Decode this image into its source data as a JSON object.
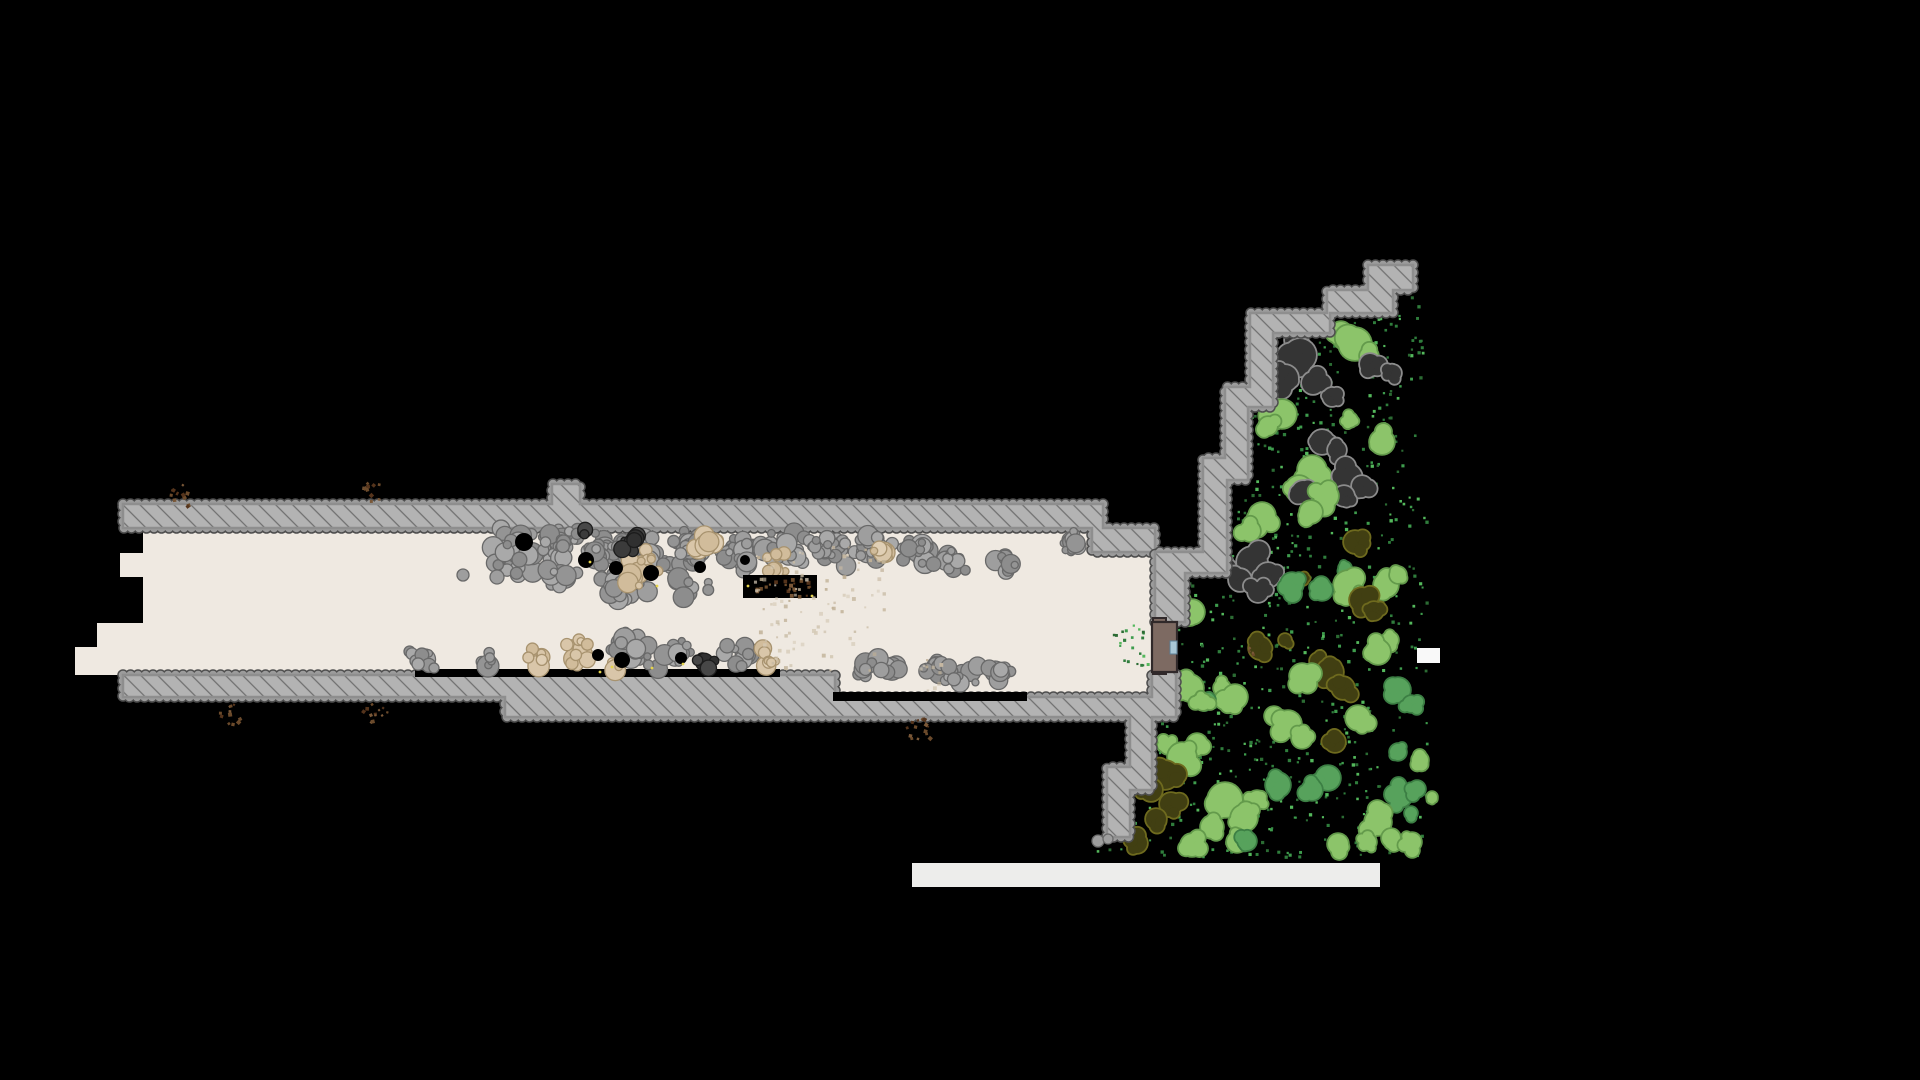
{
  "scene": {
    "width": 1920,
    "height": 1080,
    "background": "#000000",
    "palette": {
      "floor": "#EFE9E1",
      "wall_fill": "#B3B3B3",
      "wall_hatch_line": "#6F6F6F",
      "wall_bump_light": "#9C9C9C",
      "wall_bump_dark": "#4E4E4E",
      "wall_inner_edge": "#8E8E8E",
      "rock_gray": [
        "#9E9E9E",
        "#949494",
        "#A9A9A9",
        "#8D8D8D"
      ],
      "rock_gray_stroke": "#696969",
      "rock_tan": [
        "#D9C6A9",
        "#D1BC9B",
        "#E0CFB5"
      ],
      "rock_tan_stroke": "#A8936F",
      "rock_dark": [
        "#3B3B3B",
        "#303030",
        "#474747"
      ],
      "rock_dark_stroke": "#1C1C1C",
      "tree_lt": {
        "fill": "#8CC46A",
        "stroke": "#639A4B"
      },
      "tree_md": {
        "fill": "#57A25C",
        "stroke": "#3C7F44"
      },
      "tree_ol": {
        "fill": "#413F12",
        "stroke": "#6E6A1E"
      },
      "tree_ch": {
        "fill": "#343434",
        "stroke": "#8C8C8C"
      },
      "grass_dots": [
        "#3E9C4D",
        "#2F7D3C",
        "#54B85C",
        "#2B6B33"
      ],
      "sparkle": "#E5D34B",
      "debris_brown": [
        "#6B4A2B",
        "#7A5838",
        "#55341C"
      ],
      "dust_tan": [
        "#C9BBA4",
        "#BFB096",
        "#D6CBB8"
      ],
      "door_fill": "#7D6A62",
      "door_stroke": "#30292A",
      "window_fill": "#A9C7D6",
      "window_stroke": "#5B7F96",
      "bar_fill": "#EDEDEB",
      "chip_fill": "#F9F9F9",
      "black": "#000000"
    },
    "seed": 1337,
    "floor_polygon": [
      [
        143,
        528
      ],
      [
        1092,
        528
      ],
      [
        1092,
        552
      ],
      [
        1153,
        552
      ],
      [
        1153,
        697
      ],
      [
        835,
        697
      ],
      [
        835,
        675
      ],
      [
        75,
        675
      ],
      [
        75,
        647
      ],
      [
        97,
        647
      ],
      [
        97,
        623
      ],
      [
        143,
        623
      ],
      [
        143,
        577
      ],
      [
        120,
        577
      ],
      [
        120,
        553
      ],
      [
        143,
        553
      ]
    ],
    "walls": [
      {
        "name": "tunnel-top-wall",
        "points": [
          [
            123,
            504
          ],
          [
            552,
            504
          ],
          [
            552,
            484
          ],
          [
            580,
            484
          ],
          [
            580,
            504
          ],
          [
            1103,
            504
          ],
          [
            1103,
            528
          ],
          [
            1155,
            528
          ],
          [
            1155,
            552
          ],
          [
            1092,
            552
          ],
          [
            1092,
            528
          ],
          [
            123,
            528
          ]
        ]
      },
      {
        "name": "garden-upper-stair-wall",
        "points": [
          [
            1185,
            622
          ],
          [
            1185,
            573
          ],
          [
            1227,
            573
          ],
          [
            1227,
            480
          ],
          [
            1248,
            480
          ],
          [
            1248,
            407
          ],
          [
            1273,
            407
          ],
          [
            1273,
            333
          ],
          [
            1330,
            333
          ],
          [
            1330,
            313
          ],
          [
            1393,
            313
          ],
          [
            1393,
            290
          ],
          [
            1413,
            290
          ],
          [
            1413,
            265
          ],
          [
            1368,
            265
          ],
          [
            1368,
            290
          ],
          [
            1327,
            290
          ],
          [
            1327,
            313
          ],
          [
            1250,
            313
          ],
          [
            1250,
            387
          ],
          [
            1225,
            387
          ],
          [
            1225,
            458
          ],
          [
            1203,
            458
          ],
          [
            1203,
            552
          ],
          [
            1155,
            552
          ],
          [
            1155,
            622
          ]
        ]
      },
      {
        "name": "tunnel-bottom-and-lower-stair-wall",
        "points": [
          [
            123,
            675
          ],
          [
            835,
            675
          ],
          [
            835,
            697
          ],
          [
            1152,
            697
          ],
          [
            1152,
            672
          ],
          [
            1176,
            672
          ],
          [
            1176,
            717
          ],
          [
            1152,
            717
          ],
          [
            1152,
            790
          ],
          [
            1130,
            790
          ],
          [
            1130,
            837
          ],
          [
            1107,
            837
          ],
          [
            1107,
            767
          ],
          [
            1130,
            767
          ],
          [
            1130,
            717
          ],
          [
            505,
            717
          ],
          [
            505,
            697
          ],
          [
            123,
            697
          ]
        ]
      }
    ],
    "black_strips": [
      [
        415,
        669,
        365,
        8
      ],
      [
        833,
        692,
        194,
        9
      ]
    ],
    "pit": {
      "rect": [
        743,
        575,
        74,
        23
      ],
      "speck_count": 22
    },
    "rock_clusters": [
      [
        515,
        552,
        26,
        26,
        38,
        "g"
      ],
      [
        558,
        545,
        24,
        20,
        30,
        "g"
      ],
      [
        602,
        548,
        26,
        20,
        30,
        "g"
      ],
      [
        648,
        552,
        26,
        22,
        32,
        "g"
      ],
      [
        694,
        548,
        24,
        20,
        28,
        "g"
      ],
      [
        740,
        552,
        26,
        20,
        30,
        "g"
      ],
      [
        788,
        550,
        26,
        20,
        30,
        "g"
      ],
      [
        834,
        550,
        26,
        20,
        28,
        "g"
      ],
      [
        876,
        548,
        22,
        18,
        24,
        "g"
      ],
      [
        914,
        552,
        20,
        16,
        18,
        "g"
      ],
      [
        950,
        560,
        18,
        14,
        12,
        "g"
      ],
      [
        622,
        588,
        36,
        16,
        22,
        "g"
      ],
      [
        560,
        578,
        22,
        12,
        14,
        "g"
      ],
      [
        690,
        586,
        24,
        12,
        12,
        "g"
      ],
      [
        1005,
        562,
        16,
        14,
        12,
        "g"
      ],
      [
        1068,
        541,
        16,
        15,
        14,
        "g"
      ],
      [
        645,
        562,
        16,
        14,
        10,
        "t"
      ],
      [
        704,
        542,
        14,
        12,
        9,
        "t"
      ],
      [
        775,
        562,
        14,
        12,
        9,
        "t"
      ],
      [
        880,
        552,
        10,
        9,
        6,
        "t"
      ],
      [
        628,
        582,
        12,
        10,
        6,
        "t"
      ],
      [
        628,
        542,
        13,
        11,
        7,
        "d"
      ],
      [
        586,
        533,
        8,
        7,
        4,
        "d"
      ],
      [
        420,
        659,
        13,
        12,
        8,
        "g"
      ],
      [
        489,
        661,
        11,
        10,
        7,
        "g"
      ],
      [
        632,
        650,
        28,
        22,
        26,
        "g"
      ],
      [
        676,
        656,
        18,
        16,
        14,
        "g"
      ],
      [
        741,
        655,
        20,
        16,
        14,
        "g"
      ],
      [
        875,
        670,
        30,
        16,
        20,
        "g"
      ],
      [
        948,
        672,
        34,
        15,
        20,
        "g"
      ],
      [
        1000,
        674,
        18,
        12,
        10,
        "g"
      ],
      [
        540,
        658,
        14,
        13,
        8,
        "t"
      ],
      [
        578,
        650,
        20,
        19,
        12,
        "t"
      ],
      [
        614,
        664,
        9,
        8,
        5,
        "t"
      ],
      [
        768,
        658,
        12,
        11,
        7,
        "t"
      ],
      [
        703,
        662,
        12,
        11,
        7,
        "d"
      ]
    ],
    "rock_singles": [
      [
        463,
        575,
        6
      ],
      [
        497,
        577,
        7
      ],
      [
        434,
        668,
        5
      ],
      [
        1098,
        841,
        6
      ],
      [
        1108,
        839,
        5
      ]
    ],
    "black_patches": [
      [
        524,
        542,
        9
      ],
      [
        586,
        560,
        8
      ],
      [
        616,
        568,
        7
      ],
      [
        651,
        573,
        8
      ],
      [
        700,
        567,
        6
      ],
      [
        745,
        560,
        5
      ],
      [
        622,
        660,
        8
      ],
      [
        681,
        658,
        6
      ],
      [
        598,
        655,
        6
      ]
    ],
    "sparkles": [
      [
        612,
        667
      ],
      [
        600,
        672
      ],
      [
        652,
        668
      ],
      [
        590,
        562
      ],
      [
        657,
        586
      ],
      [
        748,
        586
      ],
      [
        812,
        596
      ],
      [
        683,
        664
      ]
    ],
    "tan_sprays": [
      [
        753,
        545,
        130,
        60,
        40
      ],
      [
        758,
        588,
        125,
        82,
        55
      ],
      [
        912,
        648,
        28,
        42,
        10
      ]
    ],
    "brown_speck_clusters": [
      [
        182,
        492,
        14,
        12
      ],
      [
        372,
        491,
        11,
        10
      ],
      [
        230,
        712,
        13,
        12
      ],
      [
        375,
        712,
        13,
        12
      ],
      [
        920,
        731,
        16,
        14
      ],
      [
        1252,
        650,
        5,
        4
      ]
    ],
    "trees": [
      [
        1295,
        340,
        10,
        "ch"
      ],
      [
        1341,
        332,
        10,
        "lt"
      ],
      [
        1355,
        344,
        16,
        "lt"
      ],
      [
        1300,
        355,
        16,
        "ch"
      ],
      [
        1369,
        356,
        9,
        "lt"
      ],
      [
        1268,
        362,
        7,
        "ch"
      ],
      [
        1370,
        364,
        10,
        "ch"
      ],
      [
        1393,
        373,
        8,
        "ch"
      ],
      [
        1285,
        378,
        13,
        "ch"
      ],
      [
        1313,
        383,
        11,
        "ch"
      ],
      [
        1332,
        397,
        9,
        "ch"
      ],
      [
        1282,
        414,
        14,
        "lt"
      ],
      [
        1350,
        420,
        7,
        "lt"
      ],
      [
        1268,
        426,
        9,
        "lt"
      ],
      [
        1322,
        442,
        12,
        "ch"
      ],
      [
        1382,
        442,
        12,
        "lt"
      ],
      [
        1337,
        450,
        9,
        "ch"
      ],
      [
        1312,
        470,
        14,
        "lt"
      ],
      [
        1348,
        478,
        14,
        "ch"
      ],
      [
        1362,
        486,
        10,
        "ch"
      ],
      [
        1299,
        489,
        13,
        "lt"
      ],
      [
        1303,
        492,
        11,
        "ch"
      ],
      [
        1344,
        496,
        10,
        "ch"
      ],
      [
        1326,
        496,
        12,
        "lt"
      ],
      [
        1311,
        512,
        11,
        "lt"
      ],
      [
        1262,
        516,
        13,
        "lt"
      ],
      [
        1250,
        531,
        10,
        "lt"
      ],
      [
        1355,
        542,
        11,
        "ol"
      ],
      [
        1227,
        568,
        9,
        "ch"
      ],
      [
        1252,
        562,
        15,
        "ch"
      ],
      [
        1345,
        568,
        6,
        "md"
      ],
      [
        1268,
        575,
        12,
        "ch"
      ],
      [
        1240,
        580,
        11,
        "ch"
      ],
      [
        1303,
        580,
        5,
        "ol"
      ],
      [
        1292,
        584,
        11,
        "md"
      ],
      [
        1348,
        585,
        14,
        "lt"
      ],
      [
        1386,
        585,
        12,
        "lt"
      ],
      [
        1258,
        592,
        10,
        "ch"
      ],
      [
        1322,
        590,
        10,
        "md"
      ],
      [
        1362,
        598,
        10,
        "lt"
      ],
      [
        1398,
        575,
        8,
        "lt"
      ],
      [
        1362,
        600,
        12,
        "ol"
      ],
      [
        1182,
        600,
        8,
        "lt"
      ],
      [
        1374,
        611,
        9,
        "ol"
      ],
      [
        1192,
        612,
        12,
        "lt"
      ],
      [
        1390,
        640,
        8,
        "lt"
      ],
      [
        1285,
        640,
        6,
        "ol"
      ],
      [
        1260,
        648,
        11,
        "ol"
      ],
      [
        1378,
        652,
        12,
        "lt"
      ],
      [
        1318,
        661,
        8,
        "ol"
      ],
      [
        1330,
        672,
        13,
        "ol"
      ],
      [
        1302,
        676,
        12,
        "lt"
      ],
      [
        1222,
        688,
        8,
        "lt"
      ],
      [
        1190,
        688,
        13,
        "lt"
      ],
      [
        1343,
        688,
        11,
        "ol"
      ],
      [
        1398,
        690,
        12,
        "md"
      ],
      [
        1235,
        697,
        12,
        "lt"
      ],
      [
        1208,
        700,
        7,
        "md"
      ],
      [
        1203,
        702,
        8,
        "lt"
      ],
      [
        1411,
        704,
        8,
        "md"
      ],
      [
        1274,
        716,
        9,
        "lt"
      ],
      [
        1358,
        718,
        12,
        "lt"
      ],
      [
        1288,
        724,
        13,
        "lt"
      ],
      [
        1335,
        742,
        10,
        "ol"
      ],
      [
        1197,
        744,
        10,
        "lt"
      ],
      [
        1398,
        752,
        8,
        "md"
      ],
      [
        1302,
        738,
        10,
        "lt"
      ],
      [
        1168,
        746,
        8,
        "lt"
      ],
      [
        1182,
        757,
        14,
        "lt"
      ],
      [
        1420,
        760,
        8,
        "lt"
      ],
      [
        1165,
        775,
        14,
        "ol"
      ],
      [
        1328,
        778,
        12,
        "md"
      ],
      [
        1278,
        785,
        12,
        "md"
      ],
      [
        1151,
        790,
        11,
        "ol"
      ],
      [
        1312,
        790,
        10,
        "md"
      ],
      [
        1400,
        795,
        12,
        "md"
      ],
      [
        1417,
        789,
        8,
        "md"
      ],
      [
        1225,
        800,
        17,
        "lt"
      ],
      [
        1257,
        800,
        9,
        "lt"
      ],
      [
        1171,
        804,
        11,
        "ol"
      ],
      [
        1411,
        813,
        6,
        "md"
      ],
      [
        1244,
        818,
        13,
        "lt"
      ],
      [
        1156,
        819,
        10,
        "ol"
      ],
      [
        1378,
        822,
        13,
        "lt"
      ],
      [
        1212,
        827,
        11,
        "lt"
      ],
      [
        1391,
        838,
        9,
        "lt"
      ],
      [
        1237,
        842,
        10,
        "lt"
      ],
      [
        1368,
        842,
        8,
        "lt"
      ],
      [
        1432,
        797,
        5,
        "lt"
      ],
      [
        1137,
        843,
        10,
        "ol"
      ],
      [
        1192,
        845,
        11,
        "lt"
      ],
      [
        1247,
        841,
        9,
        "md"
      ],
      [
        1338,
        844,
        10,
        "lt"
      ],
      [
        1412,
        842,
        9,
        "lt"
      ]
    ],
    "grass": {
      "polygon": [
        [
          1188,
          622
        ],
        [
          1188,
          575
        ],
        [
          1230,
          575
        ],
        [
          1230,
          482
        ],
        [
          1251,
          482
        ],
        [
          1251,
          409
        ],
        [
          1276,
          409
        ],
        [
          1276,
          336
        ],
        [
          1333,
          336
        ],
        [
          1333,
          316
        ],
        [
          1396,
          316
        ],
        [
          1396,
          293
        ],
        [
          1426,
          293
        ],
        [
          1426,
          856
        ],
        [
          1092,
          856
        ],
        [
          1092,
          840
        ],
        [
          1134,
          840
        ],
        [
          1134,
          770
        ],
        [
          1156,
          770
        ],
        [
          1156,
          722
        ],
        [
          1179,
          722
        ],
        [
          1179,
          676
        ],
        [
          1155,
          676
        ],
        [
          1155,
          622
        ]
      ],
      "count": 680,
      "tunnel_pocket": {
        "rect": [
          1112,
          624,
          40,
          44
        ],
        "count": 22
      }
    },
    "door": {
      "base": [
        1152,
        622,
        25,
        50
      ],
      "tab_top": [
        1153,
        618,
        13,
        7
      ],
      "tab_bottom": [
        1153,
        667,
        13,
        7
      ],
      "window": [
        1170,
        641,
        7,
        13
      ]
    },
    "bottom_bar": [
      912,
      863,
      468,
      24
    ],
    "white_chip": [
      1417,
      648,
      23,
      15
    ]
  }
}
